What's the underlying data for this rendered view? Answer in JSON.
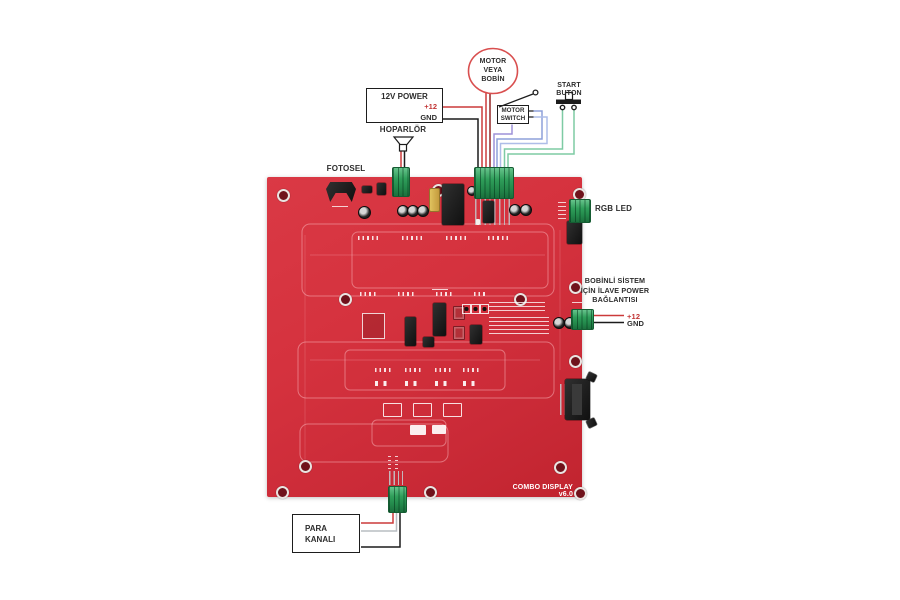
{
  "board": {
    "title": "COMBO DISPLAY v6.0"
  },
  "annotations": {
    "power": {
      "title": "12V POWER",
      "plus": "+12",
      "gnd": "GND"
    },
    "motor": {
      "line1": "MOTOR",
      "line2": "VEYA",
      "line3": "BOBİN"
    },
    "motor_switch": {
      "line1": "MOTOR",
      "line2": "SWITCH"
    },
    "start_button": {
      "line1": "START",
      "line2": "BUTON"
    },
    "speaker": {
      "label": "HOPARLÖR"
    },
    "photocell": {
      "label": "FOTOSEL"
    },
    "rgb_led": {
      "label": "RGB LED"
    },
    "aux_power": {
      "line1": "BOBİNLİ SİSTEM",
      "line2": "İÇİN İLAVE POWER",
      "line3": "BAĞLANTISI",
      "plus": "+12",
      "gnd": "GND"
    },
    "coin": {
      "line1": "PARA",
      "line2": "KANALI"
    }
  },
  "colors": {
    "board_red": "#d5323e",
    "terminal_green": "#2f9e5a",
    "outline_black": "#1d1d1d",
    "motor_circle_red": "#d94f4f",
    "accent_text_red": "#c23434",
    "wire_red": "#cc3a3a",
    "wire_dark_red": "#932626",
    "wire_black": "#1c1c1c",
    "wire_purple": "#9d92d8",
    "wire_blue": "#8da0da",
    "wire_blue_light": "#aebde8",
    "wire_green": "#7ecba4",
    "wire_gray": "#b9bdc2",
    "silkscreen_white": "#ffffff"
  }
}
